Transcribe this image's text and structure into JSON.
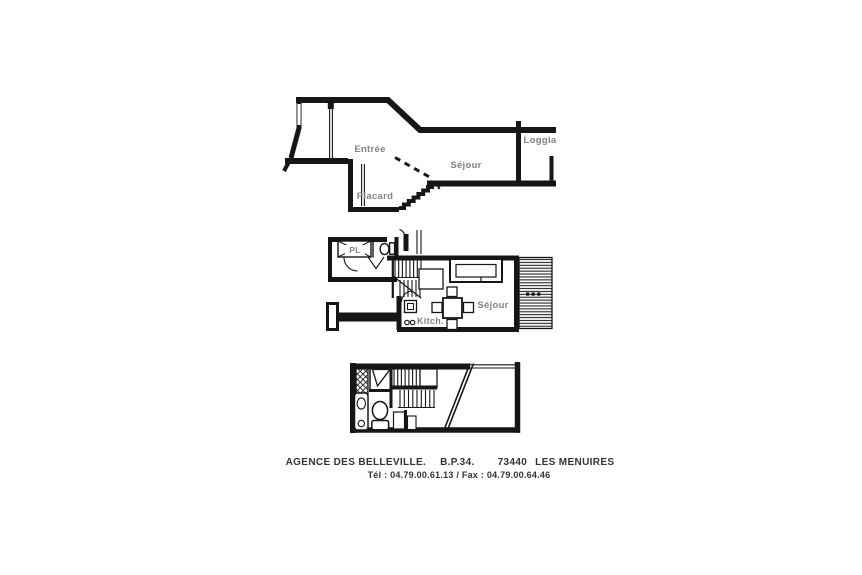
{
  "document": {
    "background": "#ffffff",
    "ink_color": "#161616",
    "label_color": "#828282",
    "footer_color": "#333333"
  },
  "plans": {
    "upper_section": {
      "labels": {
        "entree": "Entrée",
        "sejour": "Séjour",
        "loggia": "Loggia",
        "placard": "Placard"
      }
    },
    "main_floor": {
      "labels": {
        "closet": "PL",
        "sejour": "Séjour",
        "kitchen": "Kitch."
      }
    }
  },
  "footer": {
    "agency": "AGENCE DES BELLEVILLE.",
    "po_box": "B.P.34.",
    "postal_code": "73440",
    "city": "LES MENUIRES",
    "phone_fax": "Tél : 04.79.00.61.13 / Fax : 04.79.00.64.46"
  }
}
